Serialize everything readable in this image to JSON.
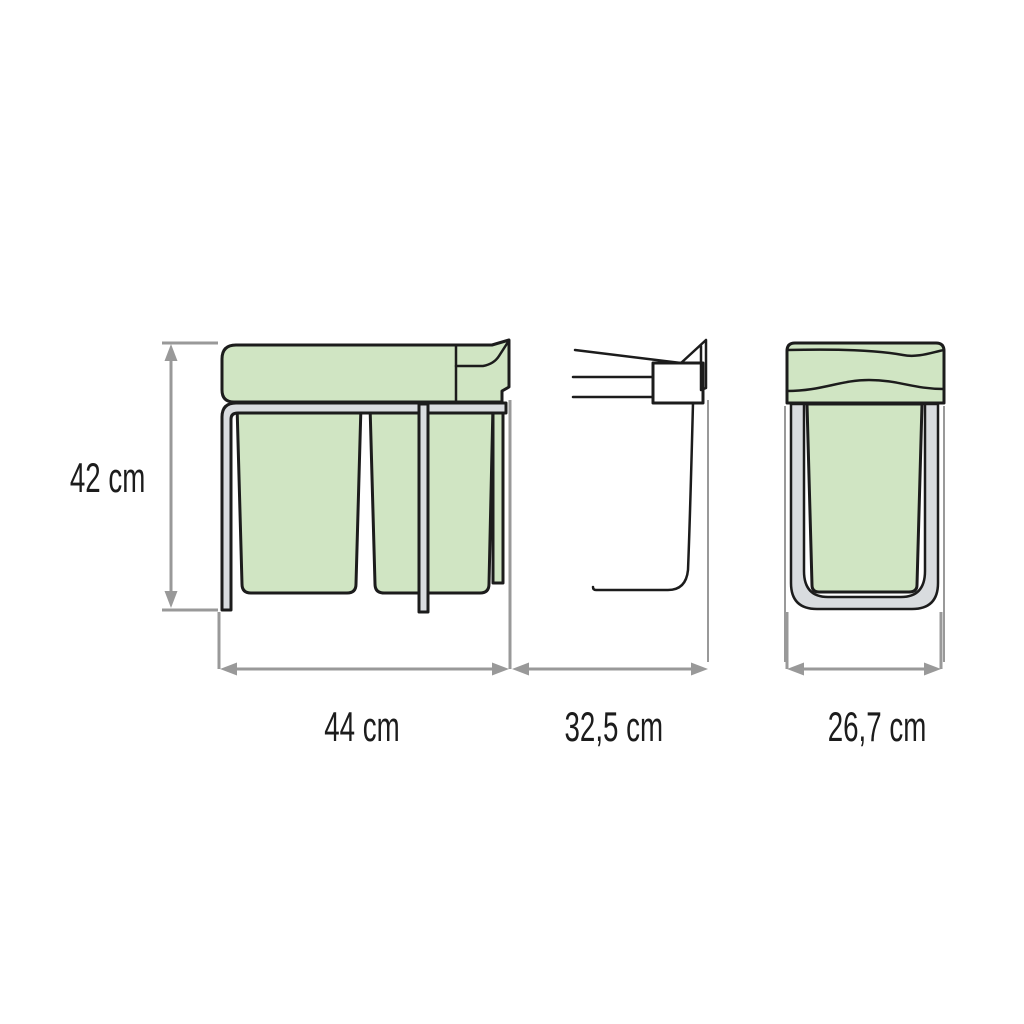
{
  "diagram": {
    "dimension_labels": {
      "height": "42 cm",
      "width": "44 cm",
      "depth": "32,5 cm",
      "front_width": "26,7 cm"
    },
    "colors": {
      "bin_green": "#d0e5c3",
      "frame_gray": "#d9dcdf",
      "bracket_white": "#ffffff",
      "outline_black": "#1c1c1c",
      "dimension_gray": "#999999",
      "background": "#ffffff"
    }
  }
}
